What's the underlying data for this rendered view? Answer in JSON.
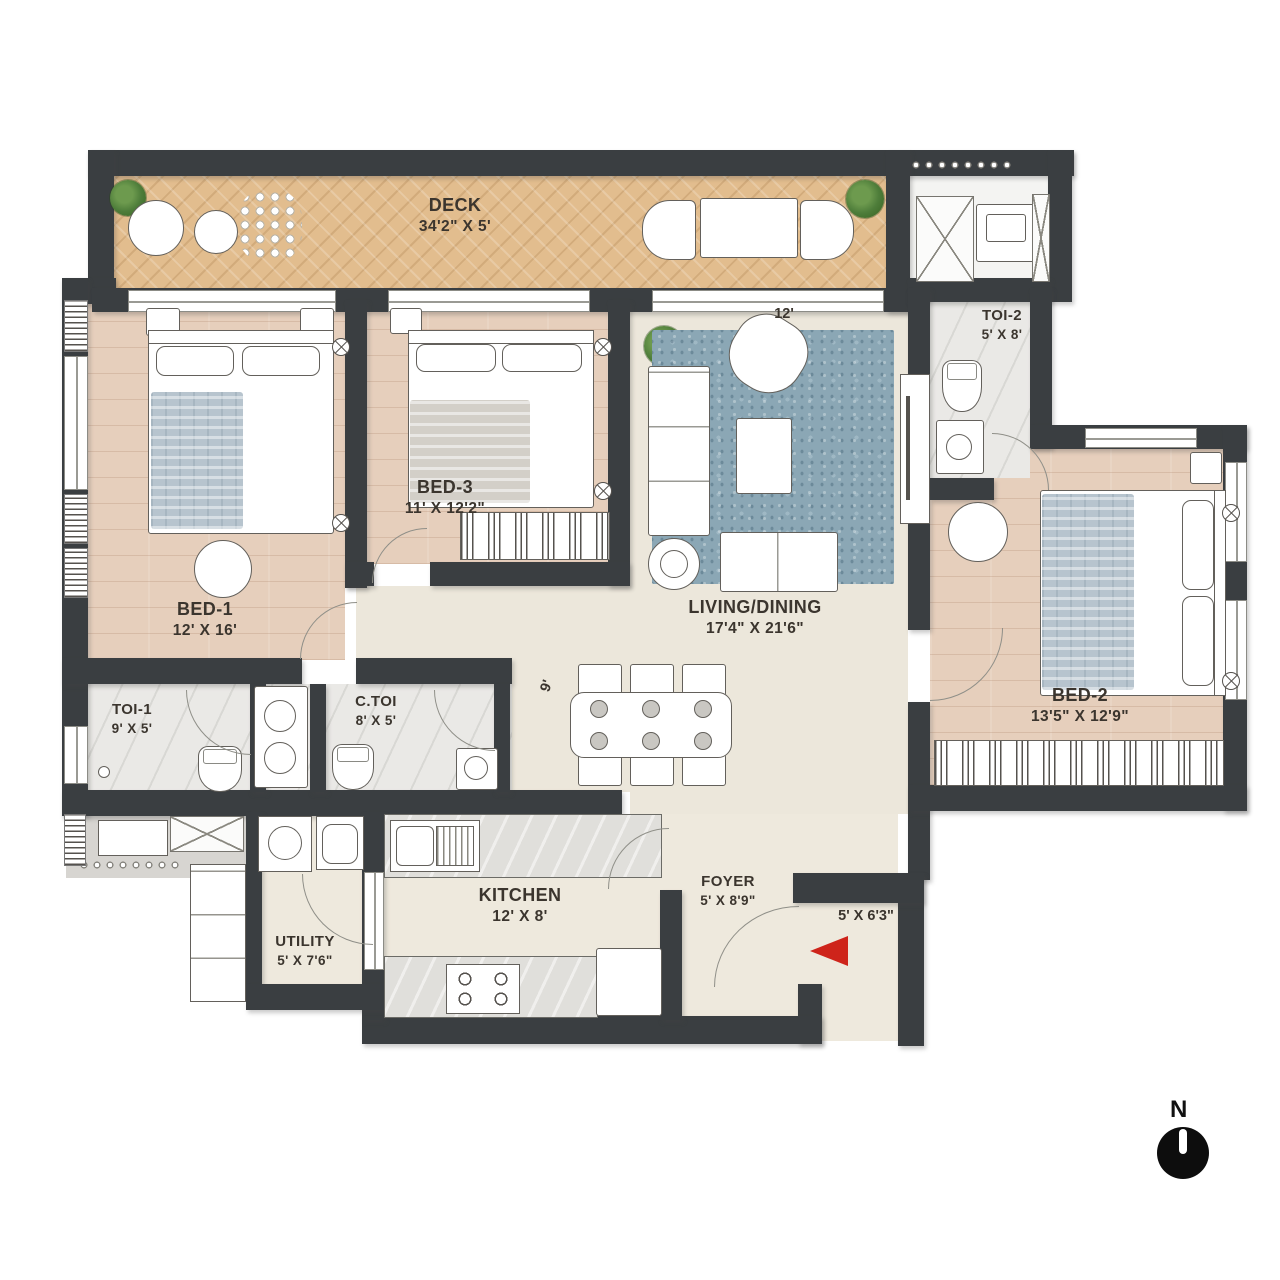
{
  "rooms": {
    "deck": {
      "label": "DECK",
      "dims": "34'2\" X 5'"
    },
    "bed1": {
      "label": "BED-1",
      "dims": "12' X 16'"
    },
    "bed3": {
      "label": "BED-3",
      "dims": "11' X 12'2\""
    },
    "living": {
      "label": "LIVING/DINING",
      "dims": "17'4\" X 21'6\""
    },
    "bed2": {
      "label": "BED-2",
      "dims": "13'5\" X 12'9\""
    },
    "toi1": {
      "label": "TOI-1",
      "dims": "9' X 5'"
    },
    "toi2": {
      "label": "TOI-2",
      "dims": "5' X 8'"
    },
    "ctoi": {
      "label": "C.TOI",
      "dims": "8' X 5'"
    },
    "kitchen": {
      "label": "KITCHEN",
      "dims": "12' X 8'"
    },
    "utility": {
      "label": "UTILITY",
      "dims": "5' X 7'6\""
    },
    "foyer": {
      "label": "FOYER",
      "dims": "5' X 8'9\""
    }
  },
  "annotations": {
    "entrance_dims": "5' X 6'3\"",
    "living_width": "12'",
    "passage_width": "9'",
    "compass_north": "N"
  },
  "colors": {
    "wall": "#3a3e41",
    "deck_wood": "#e2bd8e",
    "bedroom_wood": "#e6cfbc",
    "living_floor": "#ece7db",
    "marble": "#eae9e6",
    "rug_blue": "#8ba7b5",
    "entry_arrow_red": "#ce241a"
  }
}
